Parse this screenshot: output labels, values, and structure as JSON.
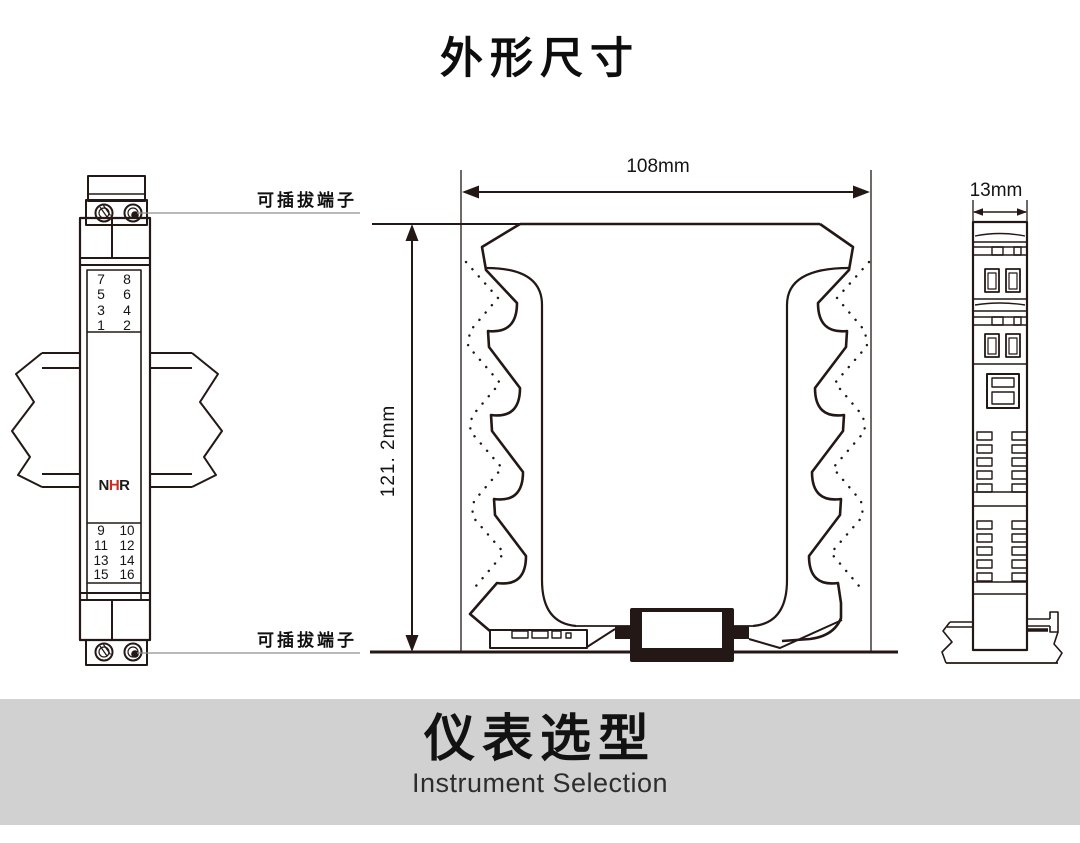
{
  "title": "外形尺寸",
  "front_view": {
    "pluggable_label_top": "可插拔端子",
    "pluggable_label_bottom": "可插拔端子",
    "brand": {
      "n": "N",
      "h": "H",
      "r": "R"
    },
    "terminals_top": [
      [
        "7",
        "8"
      ],
      [
        "5",
        "6"
      ],
      [
        "3",
        "4"
      ],
      [
        "1",
        "2"
      ]
    ],
    "terminals_bottom": [
      [
        "9",
        "10"
      ],
      [
        "11",
        "12"
      ],
      [
        "13",
        "14"
      ],
      [
        "15",
        "16"
      ]
    ]
  },
  "side_view": {
    "width_dim": "108mm",
    "height_dim": "121. 2mm"
  },
  "end_view": {
    "width_dim": "13mm"
  },
  "banner": {
    "title": "仪表选型",
    "subtitle": "Instrument Selection"
  },
  "colors": {
    "line": "#231815",
    "brand_red": "#d3281e",
    "banner_bg": "#d2d1d2",
    "leader_gray": "#8f8f8f"
  }
}
